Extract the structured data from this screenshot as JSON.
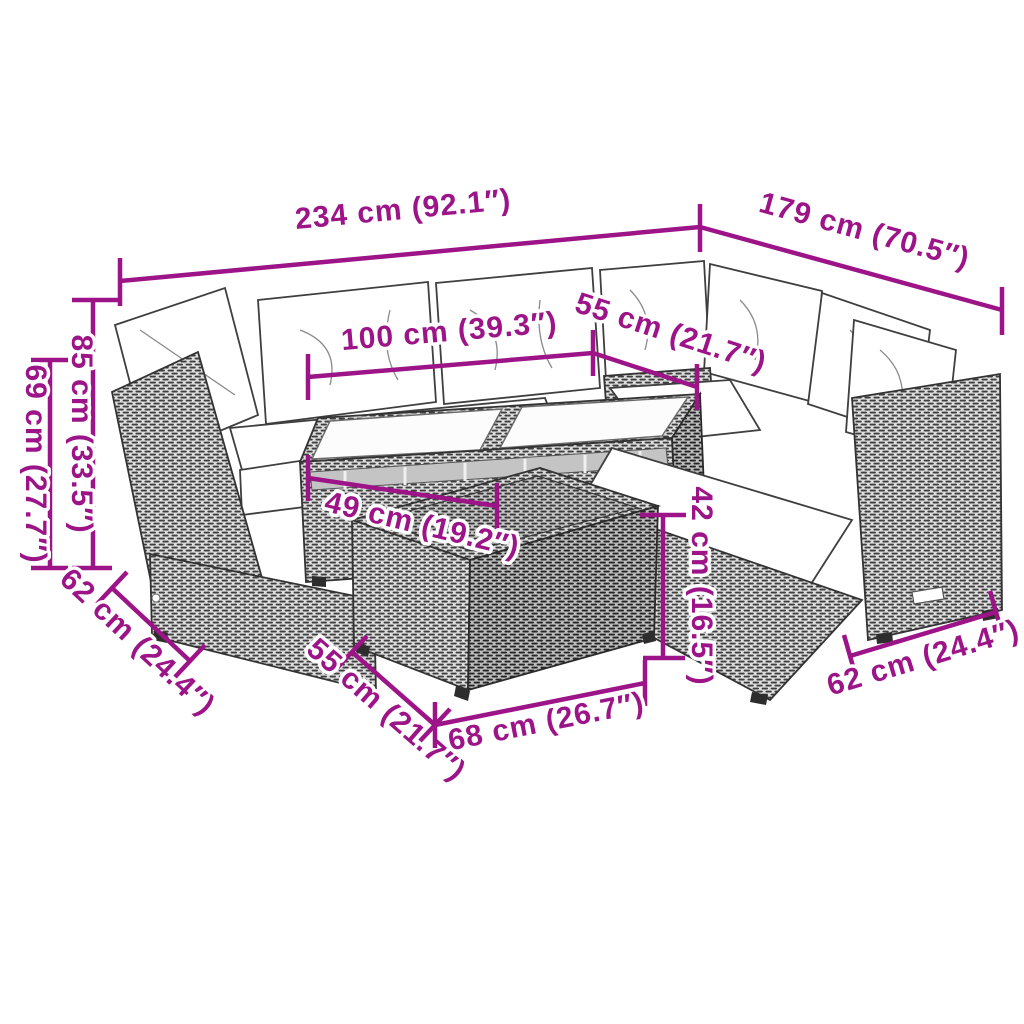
{
  "diagram": {
    "subject": "poly rattan garden lounge set with glass-top table and footstool table, line drawing with dimension annotations",
    "accent_color": "#9C1487",
    "dims": {
      "total_width": "234 cm (92.1″)",
      "right_width": "179 cm (70.5″)",
      "table_length": "100 cm (39.3″)",
      "seat_width": "55 cm (21.7″)",
      "back_height": "85 cm (33.5″)",
      "arm_height": "69 cm (27.7″)",
      "table_depth": "49 cm (19.2″)",
      "small_table_height": "42 cm (16.5″)",
      "sofa_depth_left": "62 cm (24.4″)",
      "small_table_depth": "55 cm (21.7″)",
      "small_table_length": "68 cm (26.7″)",
      "sofa_depth_right": "62 cm (24.4″)"
    }
  }
}
